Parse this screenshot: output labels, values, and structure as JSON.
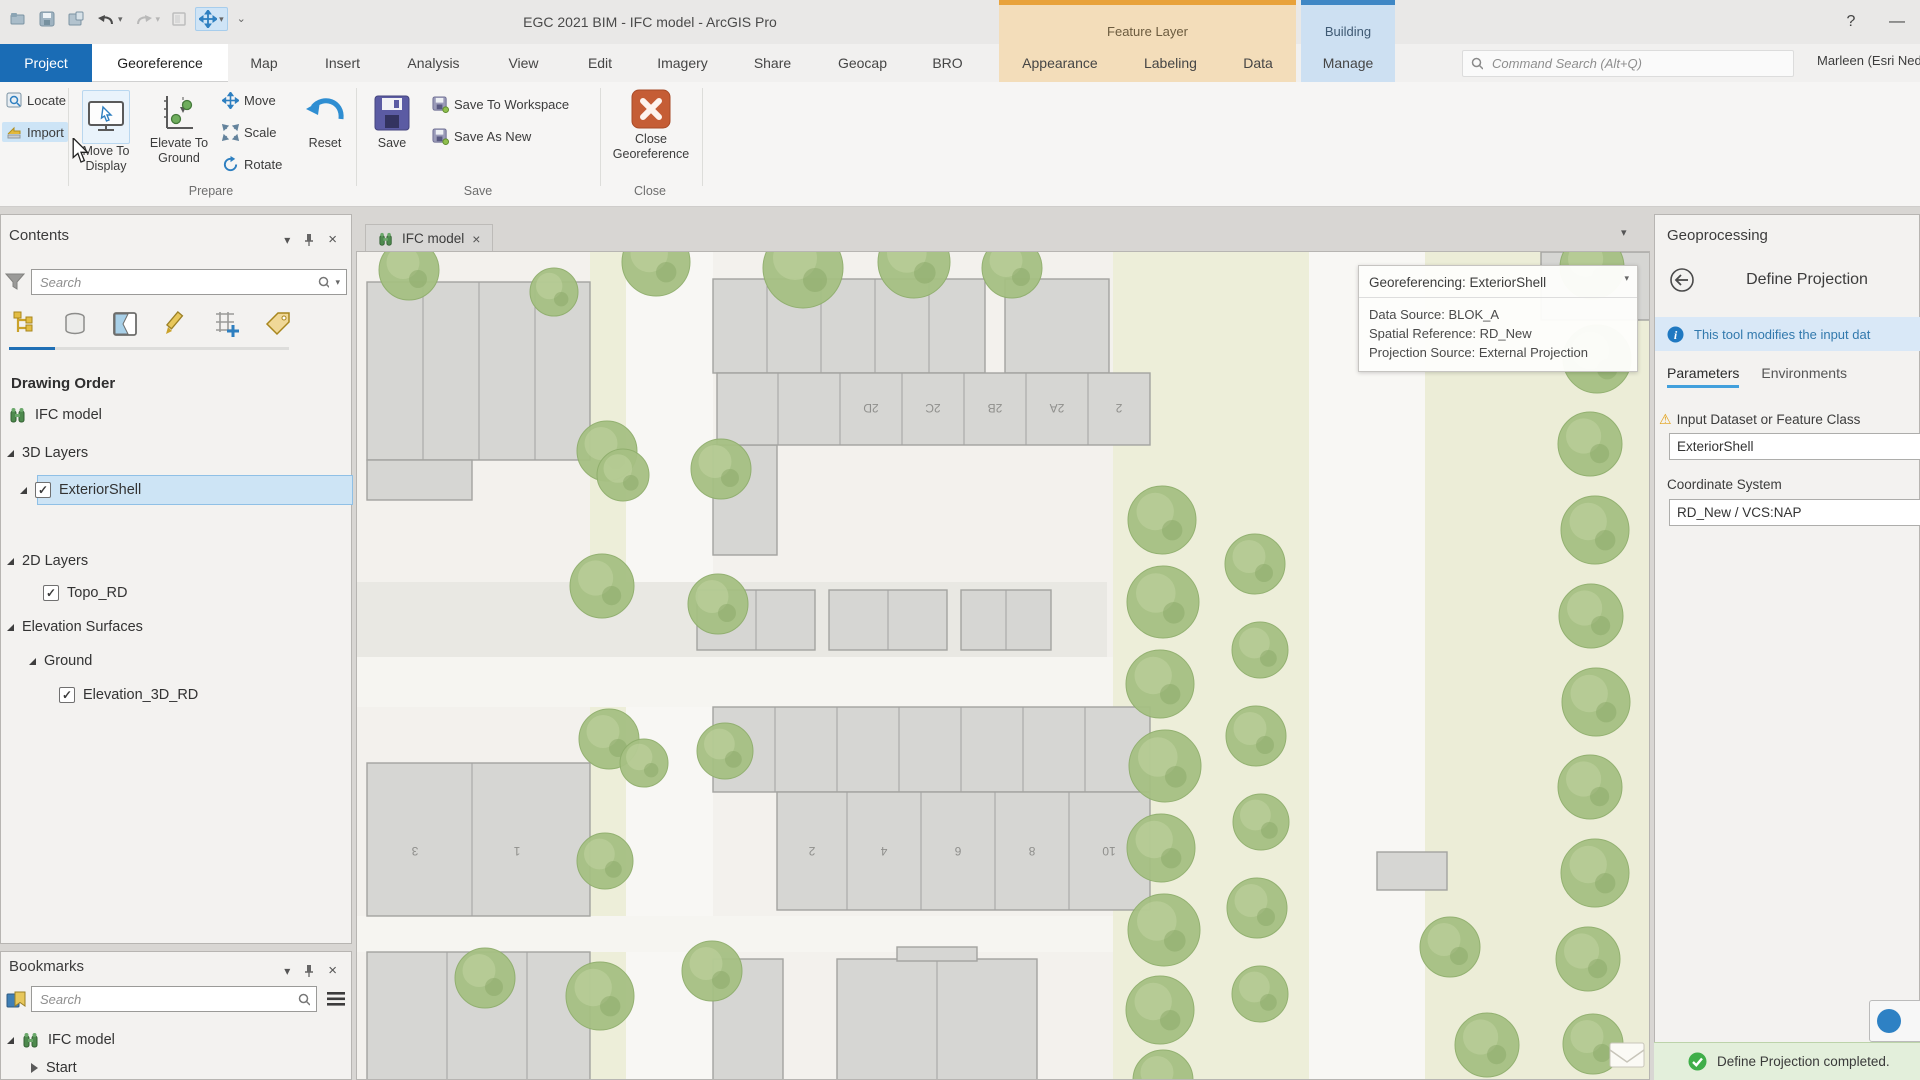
{
  "titlebar": {
    "title": "EGC 2021 BIM - IFC model - ArcGIS Pro",
    "help_label": "?",
    "minimize_label": "—",
    "feature_layer_group": "Feature Layer",
    "building_group": "Building"
  },
  "ribbon": {
    "tabs": {
      "project": "Project",
      "georeference": "Georeference",
      "map": "Map",
      "insert": "Insert",
      "analysis": "Analysis",
      "view": "View",
      "edit": "Edit",
      "imagery": "Imagery",
      "share": "Share",
      "geocap": "Geocap",
      "bro": "BRO",
      "appearance": "Appearance",
      "labeling": "Labeling",
      "data": "Data",
      "manage": "Manage"
    },
    "search_placeholder": "Command Search (Alt+Q)",
    "user_name": "Marleen (Esri Nederlan",
    "locate": "Locate",
    "import": "Import",
    "move_to_display": "Move To Display",
    "elevate_to_ground": "Elevate To Ground",
    "move": "Move",
    "scale": "Scale",
    "rotate": "Rotate",
    "reset": "Reset",
    "save": "Save",
    "save_to_workspace": "Save To Workspace",
    "save_as_new": "Save As New",
    "close_georeference": "Close Georeference",
    "group_prepare": "Prepare",
    "group_save": "Save",
    "group_close": "Close"
  },
  "contents": {
    "title": "Contents",
    "search_placeholder": "Search",
    "heading": "Drawing Order",
    "tree": [
      {
        "label": "IFC model"
      },
      {
        "label": "3D Layers"
      },
      {
        "label": "ExteriorShell"
      },
      {
        "label": "2D Layers"
      },
      {
        "label": "Topo_RD"
      },
      {
        "label": "Elevation Surfaces"
      },
      {
        "label": "Ground"
      },
      {
        "label": "Elevation_3D_RD"
      }
    ]
  },
  "bookmarks": {
    "title": "Bookmarks",
    "search_placeholder": "Search",
    "items": [
      {
        "label": "IFC model"
      },
      {
        "label": "Start"
      }
    ]
  },
  "map": {
    "tab_label": "IFC model",
    "overlay": {
      "title": "Georeferencing: ExteriorShell",
      "lines": [
        "Data Source: BLOK_A",
        "Spatial Reference: RD_New",
        "Projection Source: External Projection"
      ]
    },
    "house_labels_block2": [
      "2D",
      "2C",
      "2B",
      "2A",
      "2"
    ],
    "house_labels_block_bottom": [
      "2",
      "4",
      "6",
      "8",
      "10"
    ],
    "house_labels_block_left": [
      "3",
      "1"
    ]
  },
  "geoprocessing": {
    "title": "Geoprocessing",
    "tool_title": "Define Projection",
    "info_message": "This tool modifies the input dat",
    "tab_parameters": "Parameters",
    "tab_environments": "Environments",
    "field1_label": "Input Dataset or Feature Class",
    "field1_value": "ExteriorShell",
    "field2_label": "Coordinate System",
    "field2_value": "RD_New / VCS:NAP",
    "status_message": "Define Projection completed."
  }
}
